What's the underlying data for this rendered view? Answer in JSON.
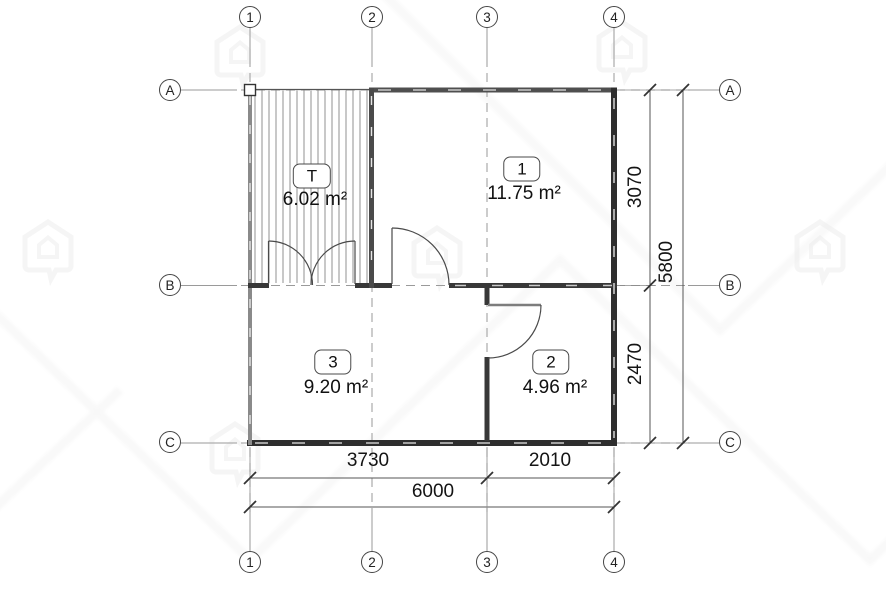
{
  "drawing": {
    "type": "floor-plan",
    "watermark_icon": "house-logo-watermark"
  },
  "grid": {
    "cols": [
      {
        "label": "1"
      },
      {
        "label": "2"
      },
      {
        "label": "3"
      },
      {
        "label": "4"
      }
    ],
    "rows": [
      {
        "label": "A"
      },
      {
        "label": "B"
      },
      {
        "label": "C"
      }
    ]
  },
  "rooms": [
    {
      "tag": "T",
      "area": "6.02 m²"
    },
    {
      "tag": "1",
      "area": "11.75 m²"
    },
    {
      "tag": "3",
      "area": "9.20 m²"
    },
    {
      "tag": "2",
      "area": "4.96 m²"
    }
  ],
  "dimensions": {
    "right_upper": "3070",
    "right_lower": "2470",
    "right_total": "5800",
    "bottom_left": "3730",
    "bottom_right": "2010",
    "bottom_total": "6000"
  },
  "colors": {
    "wall_dark": "#2e2e2e",
    "wall_medium": "#4f4f4f",
    "wall_light": "#8a8a8a",
    "dim_line": "#555555",
    "grid_line": "#999999",
    "text": "#1a1a1a",
    "watermark": "#f0f0f0"
  }
}
